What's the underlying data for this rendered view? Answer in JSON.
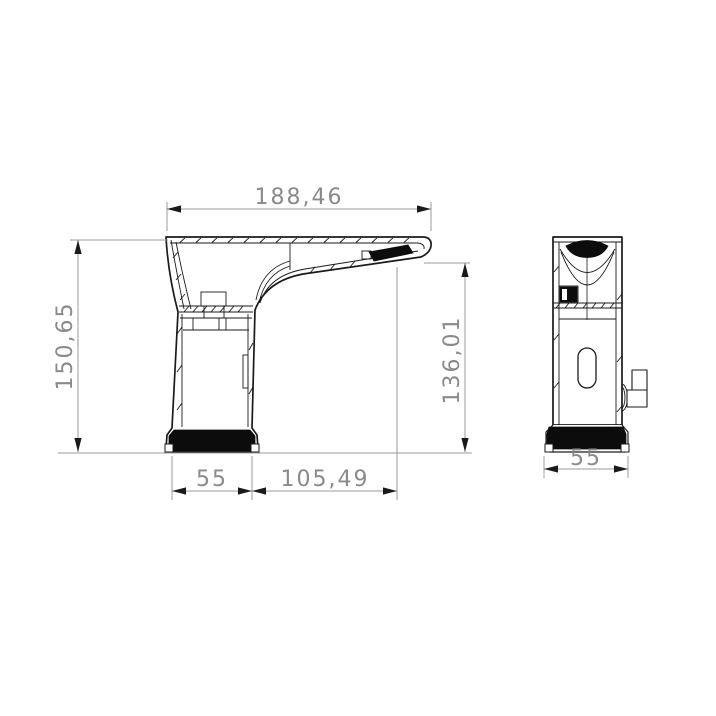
{
  "drawing": {
    "kind": "technical-drawing-two-views-of-sensor-basin-faucet",
    "colors": {
      "part_outline": "#1a1a1a",
      "dimension_lines": "#9b9b9b",
      "dimension_text": "#8a8a8a",
      "background": "#ffffff",
      "solid_fill": "#0c0c0c"
    },
    "dimensions": {
      "top_width": "188,46",
      "overall_height": "150,65",
      "outlet_height": "136,01",
      "base_width": "55",
      "spout_reach": "105,49",
      "front_base_width": "55"
    }
  }
}
